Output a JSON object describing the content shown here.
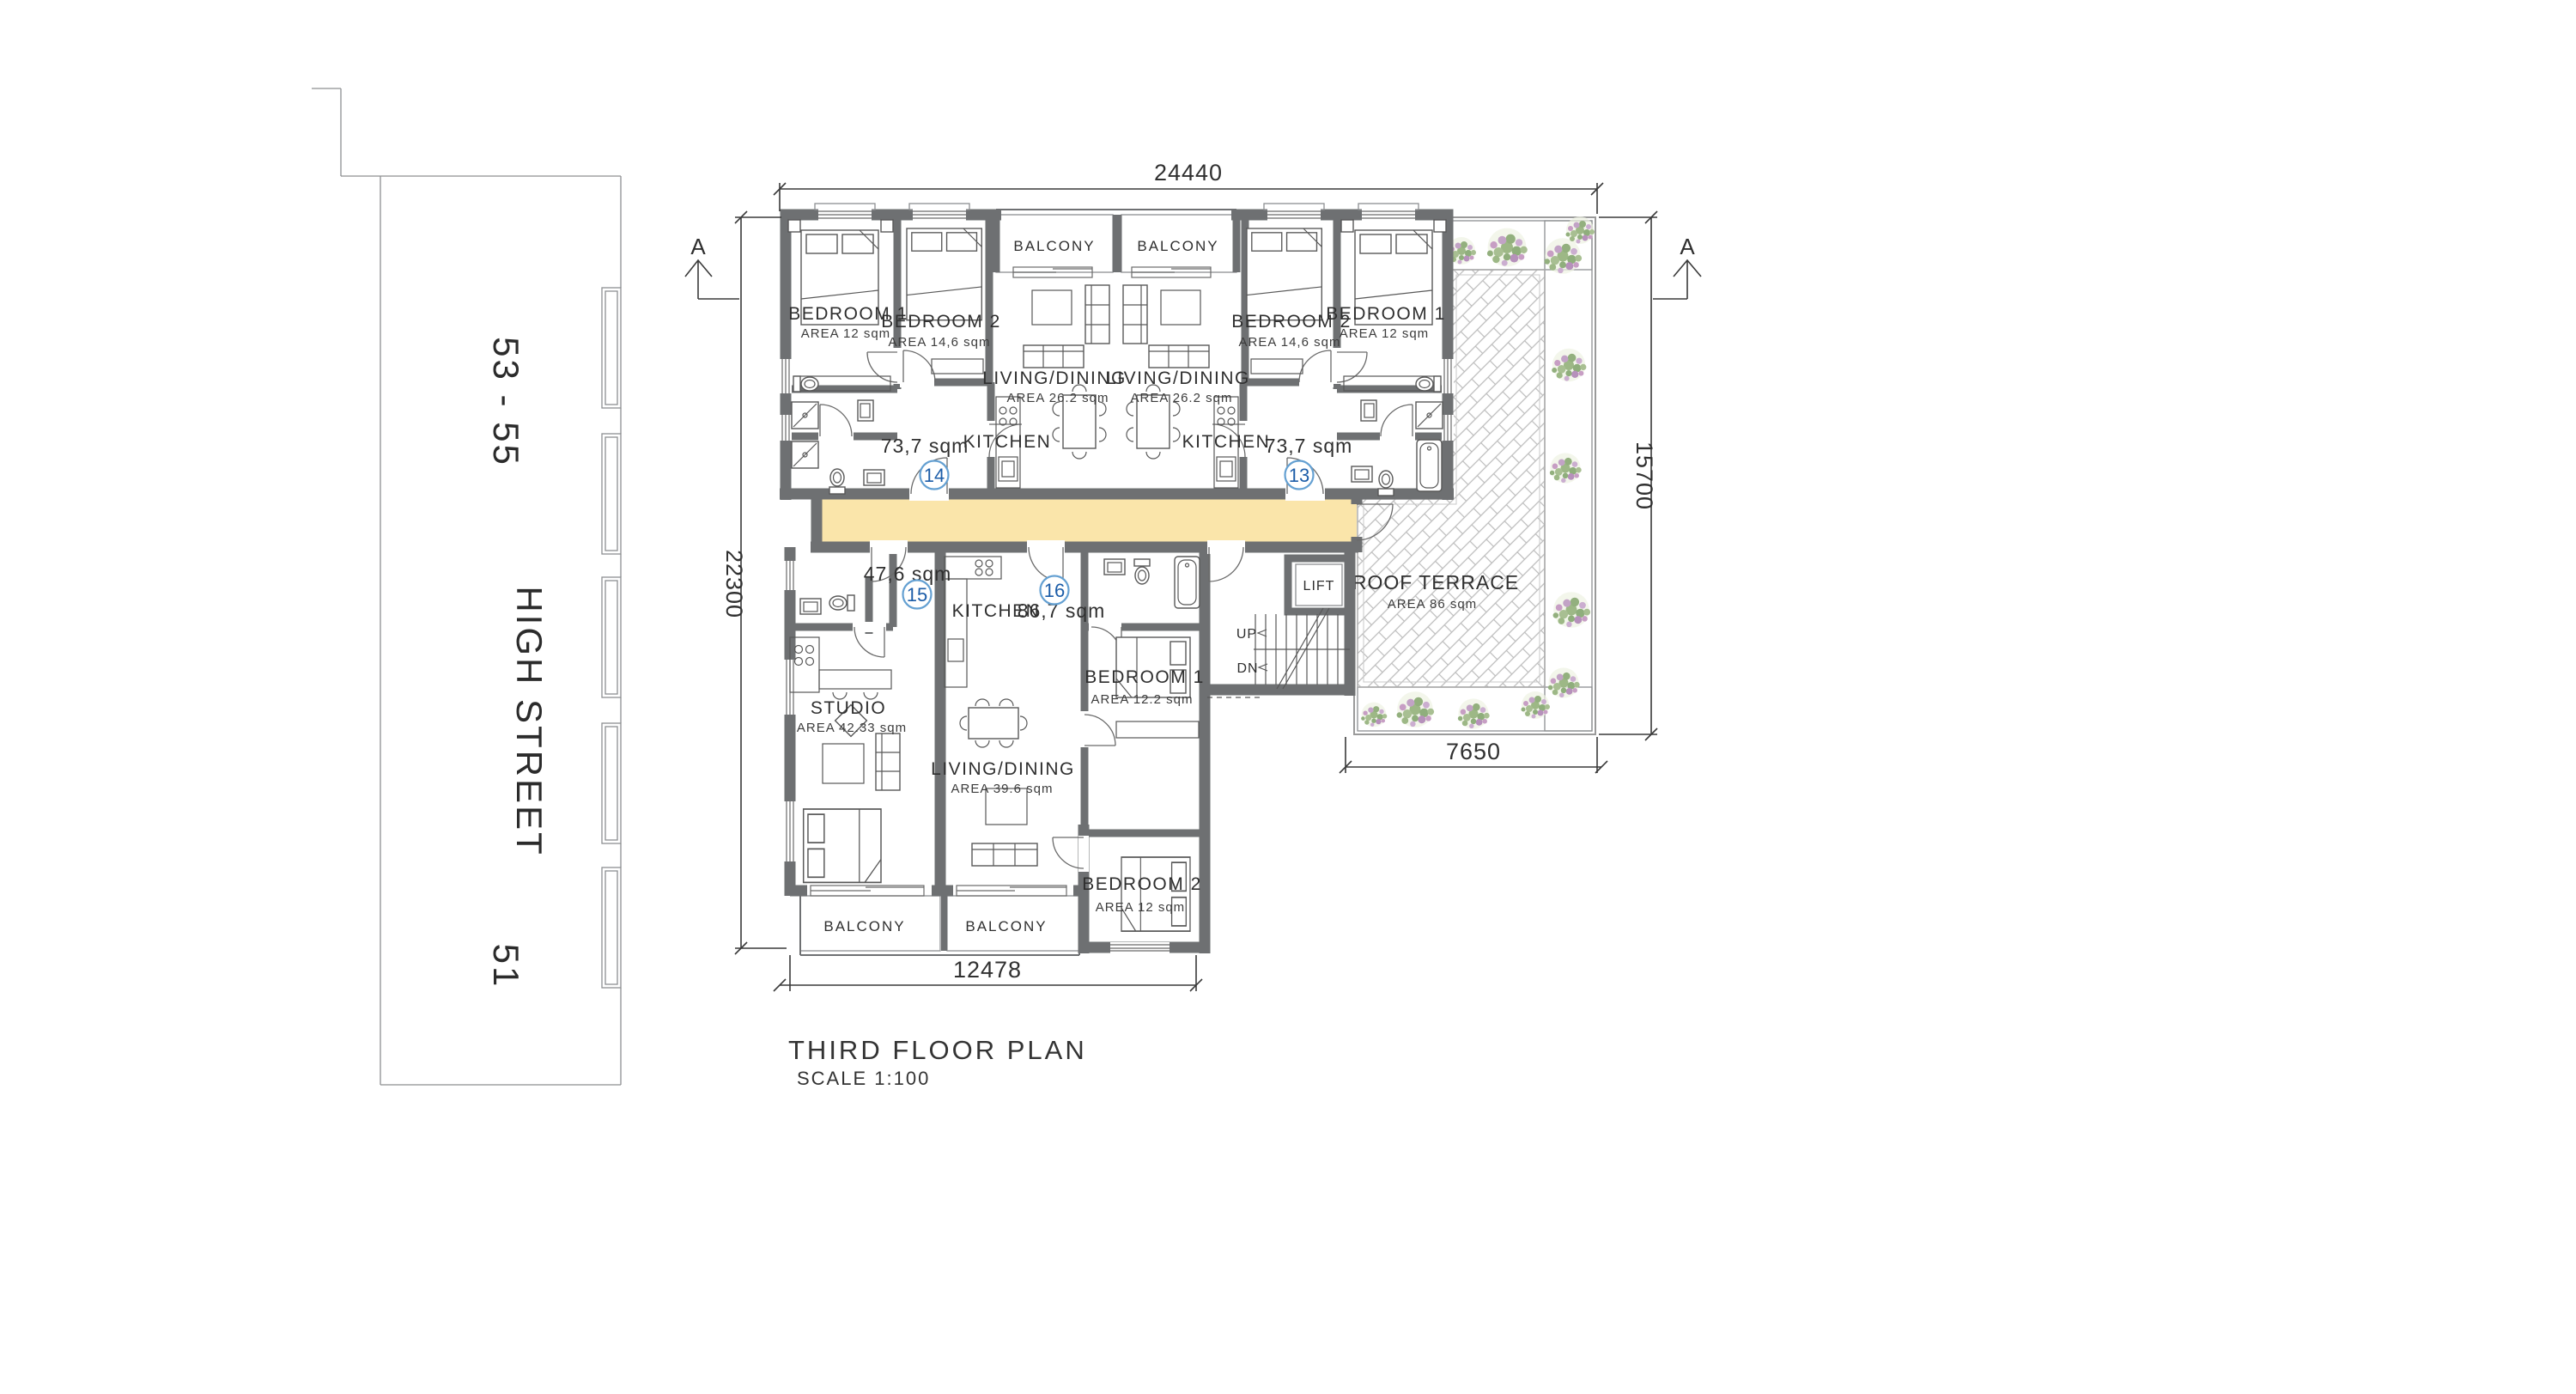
{
  "title": {
    "name": "THIRD FLOOR PLAN",
    "scale": "SCALE  1:100"
  },
  "street": {
    "numbers_top": "53 - 55",
    "name": "HIGH STREET",
    "number_bottom": "51"
  },
  "dimensions": {
    "top": "24440",
    "left": "22300",
    "right": "15700",
    "terrace_bottom": "7650",
    "bottom": "12478"
  },
  "section_markers": {
    "left": "A",
    "right": "A"
  },
  "colors": {
    "corridor": "#fae5aa",
    "wall": "#6e7072",
    "badge_ring": "#64a0d2",
    "badge_number": "#1c5da8"
  },
  "flats": {
    "u14": {
      "number": "14",
      "total": "73,7 sqm",
      "bed1": "BEDROOM 1",
      "bed1_area": "AREA  12 sqm",
      "bed2": "BEDROOM 2",
      "bed2_area": "AREA  14,6 sqm",
      "living": "LIVING/DINING",
      "living_area": "AREA 26.2 sqm",
      "kitchen": "KITCHEN",
      "balcony": "BALCONY"
    },
    "u13": {
      "number": "13",
      "total": "73,7 sqm",
      "bed1": "BEDROOM 1",
      "bed1_area": "AREA  12 sqm",
      "bed2": "BEDROOM 2",
      "bed2_area": "AREA  14,6 sqm",
      "living": "LIVING/DINING",
      "living_area": "AREA 26.2 sqm",
      "kitchen": "KITCHEN",
      "balcony": "BALCONY"
    },
    "u15": {
      "number": "15",
      "total": "47,6 sqm",
      "studio": "STUDIO",
      "studio_area": "AREA 42.33 sqm",
      "balcony": "BALCONY"
    },
    "u16": {
      "number": "16",
      "total": "86,7 sqm",
      "kitchen": "KITCHEN",
      "living": "LIVING/DINING",
      "living_area": "AREA 39.6 sqm",
      "bed1": "BEDROOM 1",
      "bed1_area": "AREA 12.2 sqm",
      "bed2": "BEDROOM 2",
      "bed2_area": "AREA 12 sqm",
      "balcony": "BALCONY"
    }
  },
  "core": {
    "lift": "LIFT",
    "up": "UP",
    "dn": "DN"
  },
  "terrace": {
    "name": "ROOF TERRACE",
    "area": "AREA 86 sqm"
  }
}
